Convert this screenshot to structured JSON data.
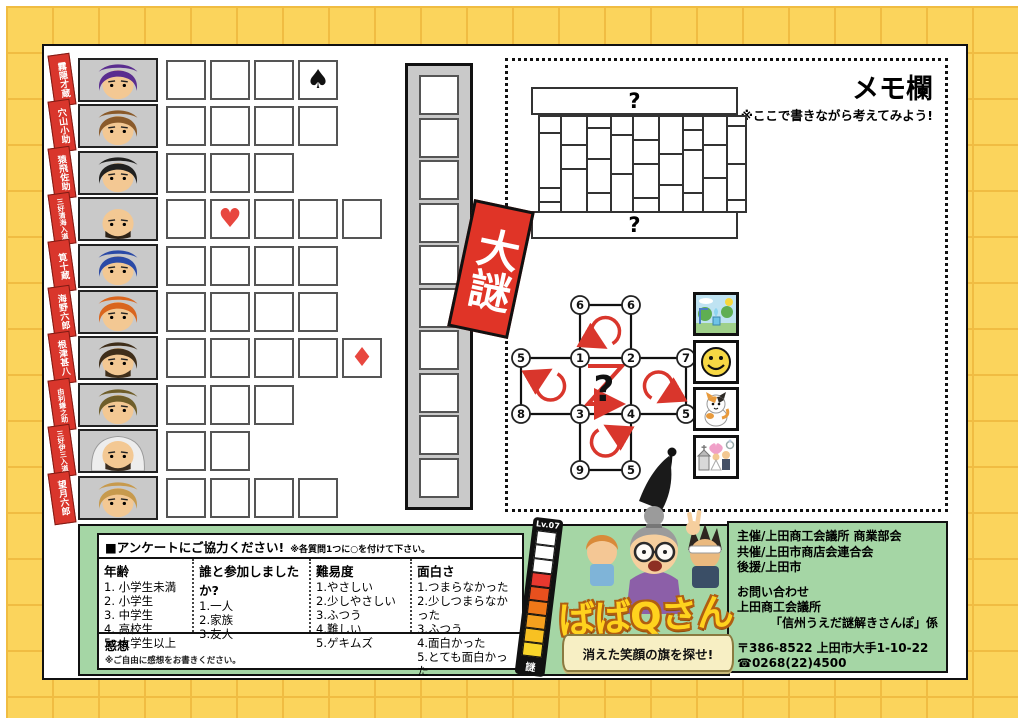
{
  "page": {
    "big_riddle_label": "大謎"
  },
  "memo": {
    "title": "メモ欄",
    "note": "※ここで書きながら考えてみよう!"
  },
  "brick_puzzle": {
    "top_label": "?",
    "bottom_label": "?"
  },
  "circle_puzzle": {
    "node_labels": [
      "6",
      "6",
      "5",
      "1",
      "2",
      "7",
      "8",
      "3",
      "4",
      "5",
      "9",
      "5"
    ],
    "center_label": "?"
  },
  "characters": [
    {
      "name": "霧隠才蔵",
      "hair": "#5a2d8f",
      "boxes": 4,
      "mark": {
        "cell": 4,
        "suit": "♠",
        "icon": "spade-mark-icon",
        "color": "#111111"
      }
    },
    {
      "name": "穴山小助",
      "hair": "#8a5a2a",
      "boxes": 4
    },
    {
      "name": "猿飛佐助",
      "hair": "#20201f",
      "boxes": 3
    },
    {
      "name": "三好清海入道",
      "bald": true,
      "beard": "#2e2318",
      "boxes": 5,
      "mark": {
        "cell": 2,
        "suit": "♥",
        "icon": "heart-mark-icon",
        "color": "#e8473f"
      }
    },
    {
      "name": "筧十蔵",
      "hair": "#2b4aa6",
      "boxes": 4
    },
    {
      "name": "海野六郎",
      "hair": "#d9651e",
      "boxes": 4
    },
    {
      "name": "根津甚八",
      "hair": "#3f2e1a",
      "beard": "#3f2e1a",
      "boxes": 5,
      "mark": {
        "cell": 5,
        "suit": "♦",
        "icon": "diamond-mark-icon",
        "color": "#e8473f"
      }
    },
    {
      "name": "由利鎌之助",
      "hair": "#6f5e2a",
      "boxes": 3
    },
    {
      "name": "三好伊三入道",
      "bald": true,
      "hood": true,
      "beard": "#3a2d20",
      "boxes": 2
    },
    {
      "name": "望月六郎",
      "hair": "#c79a4d",
      "boxes": 4
    }
  ],
  "answer_strip": {
    "box_count": 10
  },
  "pictures": [
    {
      "icon": "park-picture-icon"
    },
    {
      "icon": "smiley-picture-icon"
    },
    {
      "icon": "cat-picture-icon"
    },
    {
      "icon": "wedding-picture-icon"
    }
  ],
  "logo": {
    "level_label": "Lv.07",
    "riddle_char": "謎",
    "title": "ばばQさん",
    "tagline": "消えた笑顔の旗を探せ!"
  },
  "survey": {
    "header": "■アンケートにご協力ください!",
    "header_note": "※各質問1つに○を付けて下さい。",
    "columns": [
      {
        "title": "年齢",
        "items": [
          "1. 小学生未満",
          "2. 小学生",
          "3. 中学生",
          "4. 高校生",
          "5. 大学生以上"
        ]
      },
      {
        "title": "誰と参加しましたか?",
        "items": [
          "1.一人",
          "2.家族",
          "3.友人"
        ]
      },
      {
        "title": "難易度",
        "items": [
          "1.やさしい",
          "2.少しやさしい",
          "3.ふつう",
          "4.難しい",
          "5.ゲキムズ"
        ]
      },
      {
        "title": "面白さ",
        "items": [
          "1.つまらなかった",
          "2.少しつまらなかった",
          "3.ふつう",
          "4.面白かった",
          "5.とても面白かった"
        ]
      }
    ],
    "feedback_title": "感想",
    "feedback_note": "※ご自由に感想をお書きください。"
  },
  "contact": {
    "organizer_lines": [
      "主催/上田商工会議所 商業部会",
      "共催/上田市商店会連合会",
      "後援/上田市"
    ],
    "inquiry_lines": [
      "お問い合わせ",
      "上田商工会議所",
      "「信州うえだ謎解きさんぽ」係"
    ],
    "address_lines": [
      "〒386-8522 上田市大手1-10-22",
      "☎0268(22)4500"
    ]
  },
  "colors": {
    "accent_red": "#d9362c",
    "panel_green": "#a5d6a5",
    "background_yellow": "#fbd45c",
    "logo_yellow": "#ffd21e"
  }
}
